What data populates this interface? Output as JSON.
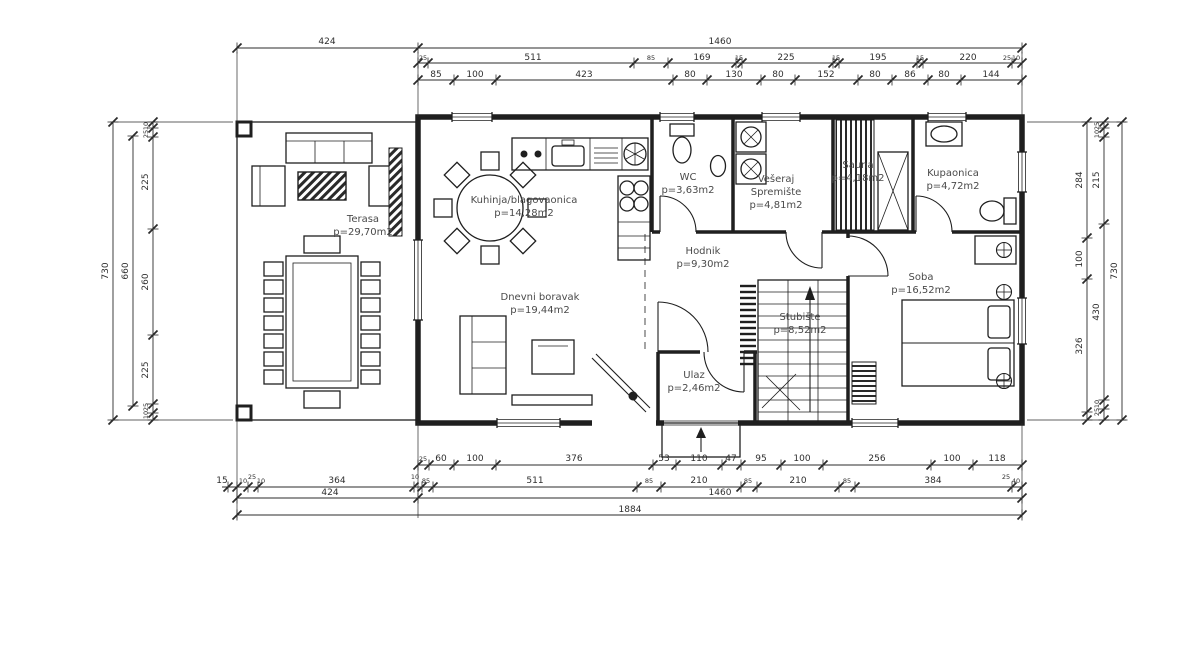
{
  "plan": {
    "title": "Floor plan",
    "rooms": [
      {
        "id": "terasa",
        "lines": [
          "Terasa",
          "p=29,70m2"
        ],
        "x": 363,
        "y": 222
      },
      {
        "id": "kuhinja-blagovaonica",
        "lines": [
          "Kuhinja/blagovaonica",
          "p=14,28m2"
        ],
        "x": 524,
        "y": 203
      },
      {
        "id": "wc",
        "lines": [
          "WC",
          "p=3,63m2"
        ],
        "x": 688,
        "y": 180
      },
      {
        "id": "veseraj-spremiste",
        "lines": [
          "Vešeraj",
          "Spremište",
          "p=4,81m2"
        ],
        "x": 776,
        "y": 182
      },
      {
        "id": "sauna",
        "lines": [
          "Sauna",
          "p=4,18m2"
        ],
        "x": 858,
        "y": 168
      },
      {
        "id": "kupaonica",
        "lines": [
          "Kupaonica",
          "p=4,72m2"
        ],
        "x": 953,
        "y": 176
      },
      {
        "id": "hodnik",
        "lines": [
          "Hodnik",
          "p=9,30m2"
        ],
        "x": 703,
        "y": 254
      },
      {
        "id": "dnevni-boravak",
        "lines": [
          "Dnevni boravak",
          "p=19,44m2"
        ],
        "x": 540,
        "y": 300
      },
      {
        "id": "stubiste",
        "lines": [
          "Stubište",
          "p=8,52m2"
        ],
        "x": 800,
        "y": 320
      },
      {
        "id": "soba",
        "lines": [
          "Soba",
          "p=16,52m2"
        ],
        "x": 921,
        "y": 280
      },
      {
        "id": "ulaz",
        "lines": [
          "Ulaz",
          "p=2,46m2"
        ],
        "x": 694,
        "y": 378
      }
    ],
    "dimensions": [
      {
        "t": "424",
        "x": 327,
        "y": 44
      },
      {
        "t": "1460",
        "x": 720,
        "y": 44
      },
      {
        "t": "25",
        "x": 423,
        "y": 60,
        "s": true
      },
      {
        "t": "511",
        "x": 533,
        "y": 60
      },
      {
        "t": "85",
        "x": 651,
        "y": 60,
        "s": true
      },
      {
        "t": "169",
        "x": 702,
        "y": 60
      },
      {
        "t": "15",
        "x": 739,
        "y": 60,
        "s": true
      },
      {
        "t": "225",
        "x": 786,
        "y": 60
      },
      {
        "t": "15",
        "x": 836,
        "y": 60,
        "s": true
      },
      {
        "t": "195",
        "x": 878,
        "y": 60
      },
      {
        "t": "15",
        "x": 920,
        "y": 60,
        "s": true
      },
      {
        "t": "220",
        "x": 968,
        "y": 60
      },
      {
        "t": "25",
        "x": 1007,
        "y": 60,
        "s": true
      },
      {
        "t": "10",
        "x": 1016,
        "y": 60,
        "s": true
      },
      {
        "t": "85",
        "x": 436,
        "y": 77
      },
      {
        "t": "100",
        "x": 475,
        "y": 77
      },
      {
        "t": "423",
        "x": 584,
        "y": 77
      },
      {
        "t": "80",
        "x": 690,
        "y": 77
      },
      {
        "t": "130",
        "x": 734,
        "y": 77
      },
      {
        "t": "80",
        "x": 778,
        "y": 77
      },
      {
        "t": "152",
        "x": 826,
        "y": 77
      },
      {
        "t": "80",
        "x": 875,
        "y": 77
      },
      {
        "t": "86",
        "x": 910,
        "y": 77
      },
      {
        "t": "80",
        "x": 944,
        "y": 77
      },
      {
        "t": "144",
        "x": 991,
        "y": 77
      },
      {
        "t": "25",
        "x": 423,
        "y": 461,
        "s": true
      },
      {
        "t": "60",
        "x": 441,
        "y": 461
      },
      {
        "t": "100",
        "x": 475,
        "y": 461
      },
      {
        "t": "376",
        "x": 574,
        "y": 461
      },
      {
        "t": "53",
        "x": 664,
        "y": 461
      },
      {
        "t": "110",
        "x": 699,
        "y": 461
      },
      {
        "t": "47",
        "x": 731,
        "y": 461
      },
      {
        "t": "95",
        "x": 761,
        "y": 461
      },
      {
        "t": "100",
        "x": 802,
        "y": 461
      },
      {
        "t": "256",
        "x": 877,
        "y": 461
      },
      {
        "t": "100",
        "x": 952,
        "y": 461
      },
      {
        "t": "118",
        "x": 997,
        "y": 461
      },
      {
        "t": "15",
        "x": 222,
        "y": 483
      },
      {
        "t": "10",
        "x": 243,
        "y": 483,
        "s": true
      },
      {
        "t": "25",
        "x": 252,
        "y": 479,
        "s": true
      },
      {
        "t": "10",
        "x": 261,
        "y": 483,
        "s": true
      },
      {
        "t": "364",
        "x": 337,
        "y": 483
      },
      {
        "t": "10",
        "x": 415,
        "y": 479,
        "s": true
      },
      {
        "t": "85",
        "x": 426,
        "y": 483,
        "s": true
      },
      {
        "t": "511",
        "x": 535,
        "y": 483
      },
      {
        "t": "85",
        "x": 649,
        "y": 483,
        "s": true
      },
      {
        "t": "210",
        "x": 699,
        "y": 483
      },
      {
        "t": "85",
        "x": 748,
        "y": 483,
        "s": true
      },
      {
        "t": "210",
        "x": 798,
        "y": 483
      },
      {
        "t": "85",
        "x": 847,
        "y": 483,
        "s": true
      },
      {
        "t": "384",
        "x": 933,
        "y": 483
      },
      {
        "t": "25",
        "x": 1006,
        "y": 479,
        "s": true
      },
      {
        "t": "40",
        "x": 1016,
        "y": 483,
        "s": true
      },
      {
        "t": "424",
        "x": 330,
        "y": 495
      },
      {
        "t": "1460",
        "x": 720,
        "y": 495
      },
      {
        "t": "1884",
        "x": 630,
        "y": 512
      },
      {
        "t": "730",
        "x": 108,
        "y": 271,
        "r": true
      },
      {
        "t": "660",
        "x": 128,
        "y": 271,
        "r": true
      },
      {
        "t": "10",
        "x": 148,
        "y": 126,
        "r": true,
        "s": true
      },
      {
        "t": "25",
        "x": 148,
        "y": 134,
        "r": true,
        "s": true
      },
      {
        "t": "225",
        "x": 148,
        "y": 182,
        "r": true
      },
      {
        "t": "260",
        "x": 148,
        "y": 282,
        "r": true
      },
      {
        "t": "225",
        "x": 148,
        "y": 370,
        "r": true
      },
      {
        "t": "25",
        "x": 148,
        "y": 407,
        "r": true,
        "s": true
      },
      {
        "t": "10",
        "x": 148,
        "y": 415,
        "r": true,
        "s": true
      },
      {
        "t": "284",
        "x": 1082,
        "y": 180,
        "r": true
      },
      {
        "t": "100",
        "x": 1082,
        "y": 259,
        "r": true
      },
      {
        "t": "326",
        "x": 1082,
        "y": 346,
        "r": true
      },
      {
        "t": "25",
        "x": 1099,
        "y": 126,
        "r": true,
        "s": true
      },
      {
        "t": "10",
        "x": 1099,
        "y": 134,
        "r": true,
        "s": true
      },
      {
        "t": "215",
        "x": 1099,
        "y": 180,
        "r": true
      },
      {
        "t": "430",
        "x": 1099,
        "y": 312,
        "r": true
      },
      {
        "t": "10",
        "x": 1099,
        "y": 404,
        "r": true,
        "s": true
      },
      {
        "t": "25",
        "x": 1099,
        "y": 412,
        "r": true,
        "s": true
      },
      {
        "t": "730",
        "x": 1117,
        "y": 271,
        "r": true
      }
    ]
  }
}
